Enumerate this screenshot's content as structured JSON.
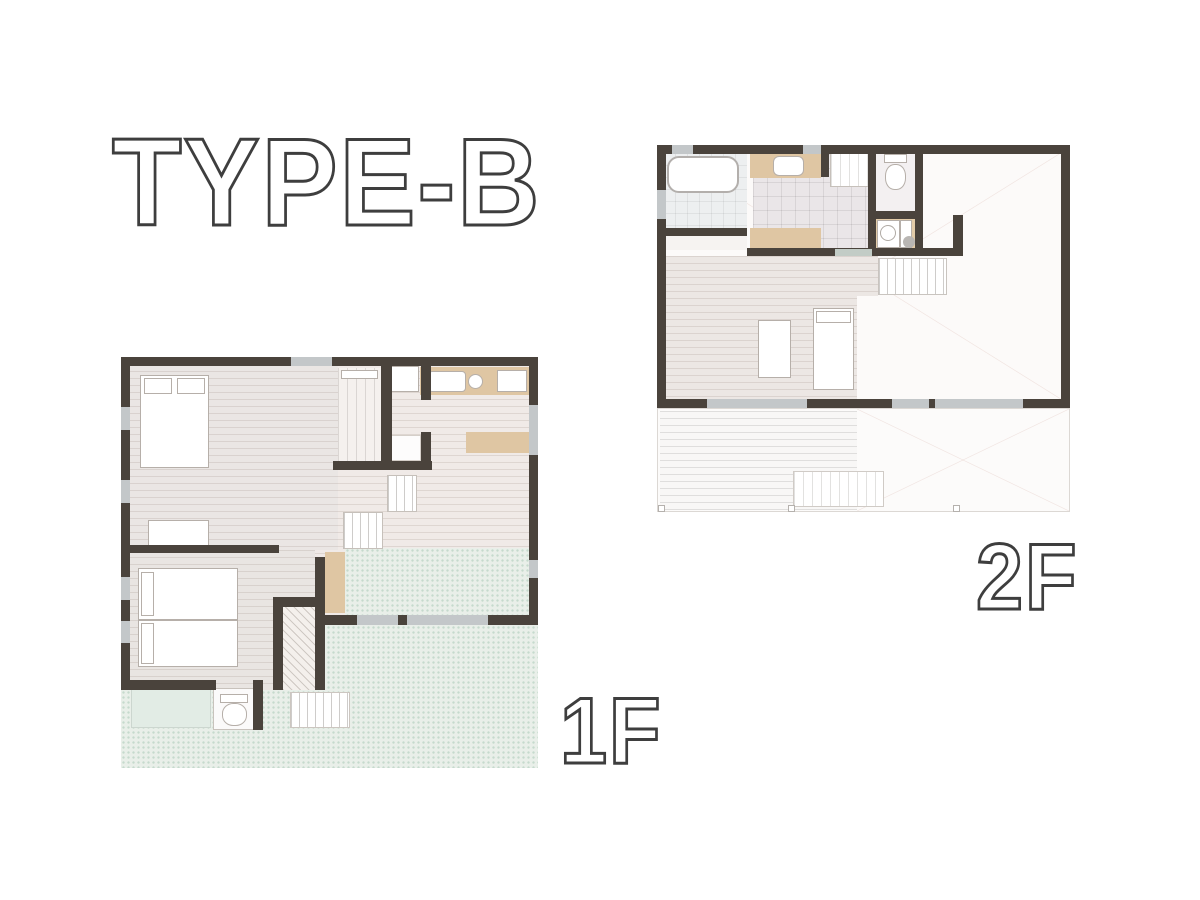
{
  "title": "TYPE-B",
  "floors": [
    {
      "label": "1F"
    },
    {
      "label": "2F"
    }
  ],
  "palette": {
    "background": "#ffffff",
    "wall": "#4a433c",
    "window_glass": "#c3c7c9",
    "counter_tan": "#dfc6a3",
    "terrace_green_dotted": "#e9efe9",
    "storage_green": "#e2ece5",
    "wood_floor": "#f0eae7",
    "tile_floor": "#eae6e8",
    "text_outline": "#3e3e3e",
    "text_fill": "#ffffff"
  }
}
